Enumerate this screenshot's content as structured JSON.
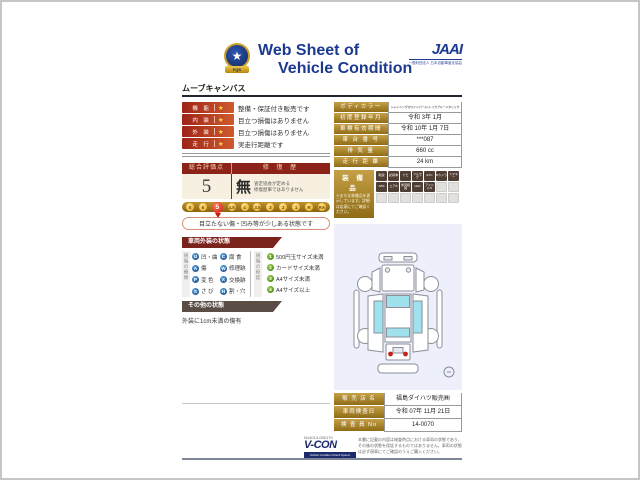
{
  "header": {
    "title_line1": "Web Sheet of",
    "title_line2": "Vehicle Condition",
    "emblem_text": "FQS",
    "star": "★",
    "jaai": "JAAI",
    "jaai_sub": "一般財団法人 日本自動車査定協会"
  },
  "vehicle_name": "ムーブキャンバス",
  "ratings": [
    {
      "label": "機 能",
      "star": "★",
      "text": "整備・保証付き販売です"
    },
    {
      "label": "内 装",
      "star": "★",
      "text": "目立つ損傷はありません"
    },
    {
      "label": "外 装",
      "star": "★",
      "text": "目立つ損傷はありません"
    },
    {
      "label": "走 行",
      "star": "★",
      "text": "実走行距離です"
    }
  ],
  "evaluation": {
    "score_header": "総合評価点",
    "history_header": "修 復 歴",
    "score": "5",
    "history_value": "無",
    "history_note1": "査定協会が定める",
    "history_note2": "修復歴車ではありません",
    "scale": [
      {
        "t": "S"
      },
      {
        "t": "6"
      },
      {
        "t": "5",
        "sel": true
      },
      {
        "t": "4.5"
      },
      {
        "t": "4"
      },
      {
        "t": "3.5"
      },
      {
        "t": "3"
      },
      {
        "t": "2"
      },
      {
        "t": "1"
      },
      {
        "t": "R"
      },
      {
        "t": "RA"
      }
    ],
    "scale_note": "目立たない傷・凹み等が少しある状態です"
  },
  "exterior": {
    "title": "車両外装の状態",
    "type_label": "損傷の種類",
    "types": [
      {
        "code": "U",
        "label": "凹・曲"
      },
      {
        "code": "C",
        "label": "腐 食"
      },
      {
        "code": "A",
        "label": "傷"
      },
      {
        "code": "W",
        "label": "修理跡"
      },
      {
        "code": "P",
        "label": "変 色"
      },
      {
        "code": "X",
        "label": "交換跡"
      },
      {
        "code": "S",
        "label": "さ び"
      },
      {
        "code": "H",
        "label": "割・穴"
      }
    ],
    "degree_label": "損傷の程度",
    "degrees": [
      {
        "code": "1",
        "label": "500円玉サイズ未満"
      },
      {
        "code": "2",
        "label": "カードサイズ未満"
      },
      {
        "code": "3",
        "label": "A4サイズ未満"
      },
      {
        "code": "4",
        "label": "A4サイズ以上"
      }
    ]
  },
  "other": {
    "title": "その他の状態",
    "note": "外装に1cm未満の傷有"
  },
  "info": {
    "rows": [
      {
        "label": "ボディカラー",
        "value": "シャイニングホワイトパール×レイクブルーメタリック",
        "small": true
      },
      {
        "label": "初度登録年月",
        "value": "令和 3年 1月"
      },
      {
        "label": "車検有効期間",
        "value": "令和 10年 1月 7日"
      },
      {
        "label": "車 台 番 号",
        "value": "***087"
      },
      {
        "label": "排 気 量",
        "value": "660 cc"
      },
      {
        "label": "走 行 距 離",
        "value": "24 km"
      }
    ]
  },
  "equipment": {
    "title": "装 備 品",
    "note": "※おもな装備品を表示しています。詳細は店頭にてご確認ください。",
    "badges": [
      {
        "t": "取説",
        "on": true
      },
      {
        "t": "記録簿",
        "on": true
      },
      {
        "t": "ナビ",
        "on": true
      },
      {
        "t": "フルセグ",
        "on": true
      },
      {
        "t": "ETC",
        "on": true
      },
      {
        "t": "Bカメラ",
        "on": true
      },
      {
        "t": "スマキー",
        "on": true
      },
      {
        "t": "ABS",
        "on": true
      },
      {
        "t": "エアB",
        "on": true
      },
      {
        "t": "衝突軽減",
        "on": true
      },
      {
        "t": "LED",
        "on": true
      },
      {
        "t": "アイドルS",
        "on": true
      },
      {
        "t": "",
        "off": true
      },
      {
        "t": "",
        "off": true
      },
      {
        "t": "",
        "off": true
      },
      {
        "t": "",
        "off": true
      },
      {
        "t": "",
        "off": true
      },
      {
        "t": "",
        "off": true
      },
      {
        "t": "",
        "off": true
      },
      {
        "t": "",
        "off": true
      },
      {
        "t": "",
        "off": true
      }
    ]
  },
  "sales": {
    "rows": [
      {
        "label": "販 売 店 名",
        "value": "福島ダイハツ販売㈱"
      },
      {
        "label": "車両検査日",
        "value": "令和 07年 11月 21日"
      },
      {
        "label": "検 査 員 No",
        "value": "14-0070"
      }
    ]
  },
  "footer": {
    "serial": "N14013-000170",
    "vcon": "V-CON",
    "vcon_sub": "Vehicle Condition Check System",
    "disclaimer": "本書に記載の内容は検査時点における車両の状態であり、その後の状態を保証するものではありません。車両の状態は必ず現車にてご確認のうえご購入ください。"
  },
  "colors": {
    "accent_blue": "#1b3a8f",
    "maroon": "#8c2318",
    "gold": "#b08a28",
    "window_cyan": "#9fe2ee",
    "taillamp_red": "#c22418"
  }
}
